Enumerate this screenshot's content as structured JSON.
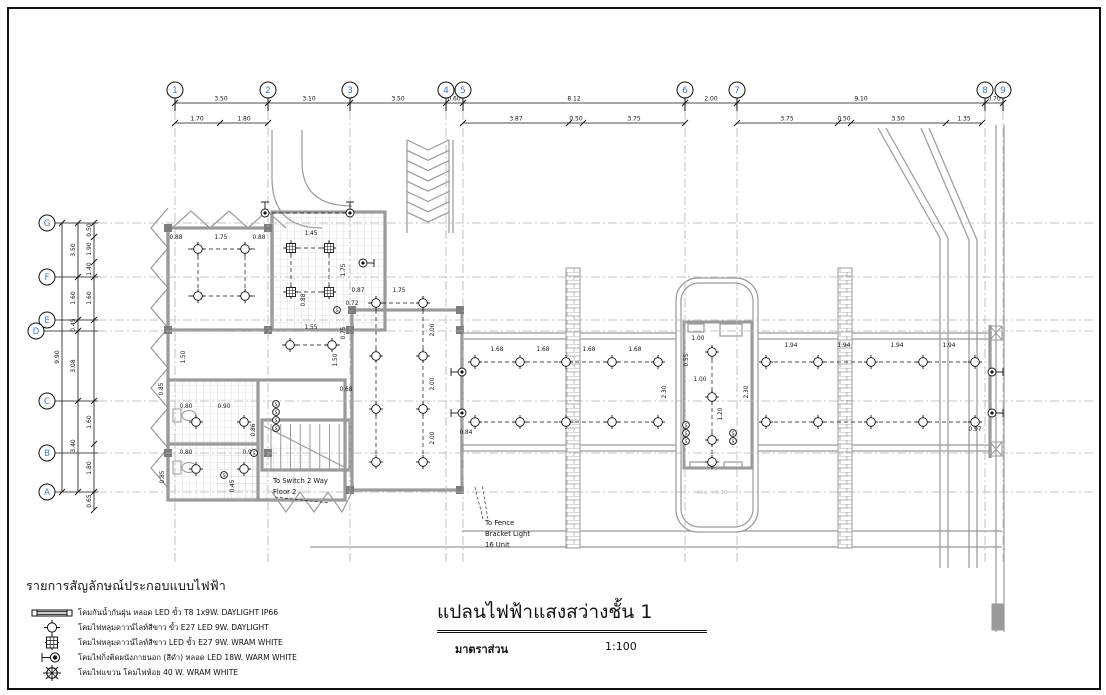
{
  "colors": {
    "line": "#111111",
    "wall": "#9a9a9a",
    "wall_dark": "#7d7d7d",
    "grid": "#b4b4b4",
    "bubble_num": "#3f7cc0",
    "faint": "#bdbdbd",
    "tile": "#c9c9c9"
  },
  "grid": {
    "columns": [
      {
        "label": "1",
        "x": 175
      },
      {
        "label": "2",
        "x": 268
      },
      {
        "label": "3",
        "x": 350
      },
      {
        "label": "4",
        "x": 446
      },
      {
        "label": "5",
        "x": 463
      },
      {
        "label": "6",
        "x": 685
      },
      {
        "label": "7",
        "x": 737
      },
      {
        "label": "8",
        "x": 985
      },
      {
        "label": "9",
        "x": 1003
      }
    ],
    "rows": [
      {
        "label": "G",
        "y": 223
      },
      {
        "label": "F",
        "y": 277
      },
      {
        "label": "E",
        "y": 320
      },
      {
        "label": "D",
        "y": 331
      },
      {
        "label": "C",
        "y": 401
      },
      {
        "label": "B",
        "y": 453
      },
      {
        "label": "A",
        "y": 492
      }
    ],
    "dim_row1": {
      "y": 103,
      "ticks": [
        175,
        268,
        350,
        446,
        463,
        685,
        737,
        985,
        1003
      ],
      "segs": [
        {
          "t": "3.50",
          "x": 221
        },
        {
          "t": "3.10",
          "x": 309
        },
        {
          "t": "3.50",
          "x": 398
        },
        {
          "t": "0.60",
          "x": 454
        },
        {
          "t": "8.12",
          "x": 574
        },
        {
          "t": "2.00",
          "x": 711
        },
        {
          "t": "9.10",
          "x": 861
        },
        {
          "t": "0.70",
          "x": 994
        }
      ]
    },
    "dim_row2": {
      "y": 123,
      "lines": [
        [
          175,
          268
        ],
        [
          463,
          685
        ],
        [
          737,
          982
        ]
      ],
      "ticks": [
        175,
        220,
        268,
        463,
        569,
        583,
        685,
        737,
        838,
        851,
        946,
        982
      ],
      "segs": [
        {
          "t": "1.70",
          "x": 197
        },
        {
          "t": "1.80",
          "x": 244
        },
        {
          "t": "3.87",
          "x": 516
        },
        {
          "t": "0.50",
          "x": 576
        },
        {
          "t": "3.75",
          "x": 634
        },
        {
          "t": "3.75",
          "x": 787
        },
        {
          "t": "0.50",
          "x": 844
        },
        {
          "t": "3.50",
          "x": 898
        },
        {
          "t": "1.35",
          "x": 964
        }
      ]
    },
    "left_dims": {
      "lines": [
        {
          "x": 62,
          "y1": 223,
          "y2": 492
        },
        {
          "x": 78,
          "y1": 223,
          "y2": 492
        },
        {
          "x": 94,
          "y1": 223,
          "y2": 510
        }
      ],
      "ticks": {
        "62": [
          223,
          492
        ],
        "78": [
          223,
          277,
          320,
          331,
          401,
          492
        ],
        "94": [
          223,
          237,
          262,
          277,
          320,
          401,
          444,
          492,
          510
        ]
      },
      "texts": [
        {
          "t": "9.90",
          "x": 62,
          "y": 357
        },
        {
          "t": "3.50",
          "x": 78,
          "y": 250
        },
        {
          "t": "1.60",
          "x": 78,
          "y": 298
        },
        {
          "t": "0.45",
          "x": 78,
          "y": 325
        },
        {
          "t": "3.08",
          "x": 78,
          "y": 366
        },
        {
          "t": "3.40",
          "x": 78,
          "y": 446
        },
        {
          "t": "0.50",
          "x": 94,
          "y": 230
        },
        {
          "t": "1.90",
          "x": 94,
          "y": 249
        },
        {
          "t": "1.40",
          "x": 94,
          "y": 269
        },
        {
          "t": "1.60",
          "x": 94,
          "y": 298
        },
        {
          "t": "1.60",
          "x": 94,
          "y": 422
        },
        {
          "t": "1.80",
          "x": 94,
          "y": 468
        },
        {
          "t": "0.65",
          "x": 94,
          "y": 501
        }
      ]
    }
  },
  "plan": {
    "dims": [
      [
        "0.88",
        176,
        239,
        0
      ],
      [
        "1.75",
        221,
        239,
        0
      ],
      [
        "0.88",
        259,
        239,
        0
      ],
      [
        "1.45",
        311,
        235,
        0
      ],
      [
        "1.75",
        345,
        270,
        1
      ],
      [
        "0.88",
        305,
        300,
        1
      ],
      [
        "0.87",
        358,
        292,
        0
      ],
      [
        "1.75",
        399,
        292,
        0
      ],
      [
        "0.72",
        352,
        305,
        0
      ],
      [
        "1.55",
        311,
        329,
        0
      ],
      [
        "0.75",
        345,
        333,
        1
      ],
      [
        "1.50",
        185,
        357,
        1
      ],
      [
        "1.50",
        337,
        360,
        1
      ],
      [
        "2.00",
        434,
        330,
        1
      ],
      [
        "2.00",
        434,
        384,
        1
      ],
      [
        "2.00",
        434,
        438,
        1
      ],
      [
        "0.68",
        346,
        391,
        0
      ],
      [
        "0.80",
        186,
        408,
        0
      ],
      [
        "0.90",
        224,
        408,
        0
      ],
      [
        "0.85",
        163,
        389,
        1
      ],
      [
        "0.86",
        255,
        430,
        1
      ],
      [
        "0.80",
        186,
        454,
        0
      ],
      [
        "0.90",
        249,
        454,
        0
      ],
      [
        "0.85",
        164,
        477,
        1
      ],
      [
        "0.45",
        234,
        486,
        1
      ],
      [
        "0.84",
        466,
        434,
        0
      ],
      [
        "1.68",
        497,
        351,
        0
      ],
      [
        "1.68",
        543,
        351,
        0
      ],
      [
        "1.68",
        589,
        351,
        0
      ],
      [
        "1.68",
        635,
        351,
        0
      ],
      [
        "2.30",
        666,
        392,
        1
      ],
      [
        "2.30",
        748,
        392,
        1
      ],
      [
        "1.94",
        791,
        347,
        0
      ],
      [
        "1.94",
        844,
        347,
        0
      ],
      [
        "1.94",
        897,
        347,
        0
      ],
      [
        "1.94",
        949,
        347,
        0
      ],
      [
        "0.97",
        975,
        431,
        0
      ],
      [
        "1.00",
        698,
        340,
        0
      ],
      [
        "0.55",
        688,
        360,
        1
      ],
      [
        "1.00",
        700,
        381,
        0
      ],
      [
        "1.20",
        722,
        414,
        1
      ]
    ],
    "lights": {
      "down": [
        [
          198,
          249
        ],
        [
          245,
          249
        ],
        [
          198,
          296
        ],
        [
          245,
          296
        ],
        [
          290,
          345
        ],
        [
          332,
          345
        ],
        [
          196,
          422
        ],
        [
          244,
          422
        ],
        [
          196,
          469
        ],
        [
          244,
          469
        ],
        [
          376,
          303
        ],
        [
          423,
          303
        ],
        [
          376,
          356
        ],
        [
          423,
          356
        ],
        [
          376,
          409
        ],
        [
          423,
          409
        ],
        [
          376,
          462
        ],
        [
          423,
          462
        ],
        [
          475,
          362
        ],
        [
          520,
          362
        ],
        [
          566,
          362
        ],
        [
          612,
          362
        ],
        [
          658,
          362
        ],
        [
          475,
          422
        ],
        [
          520,
          422
        ],
        [
          566,
          422
        ],
        [
          612,
          422
        ],
        [
          658,
          422
        ],
        [
          766,
          362
        ],
        [
          818,
          362
        ],
        [
          871,
          362
        ],
        [
          923,
          362
        ],
        [
          975,
          362
        ],
        [
          766,
          422
        ],
        [
          818,
          422
        ],
        [
          871,
          422
        ],
        [
          923,
          422
        ],
        [
          975,
          422
        ],
        [
          712,
          352
        ],
        [
          712,
          397
        ],
        [
          712,
          440
        ],
        [
          712,
          462
        ]
      ],
      "warm": [
        [
          291,
          248
        ],
        [
          329,
          248
        ],
        [
          291,
          292
        ],
        [
          329,
          292
        ]
      ],
      "bracket": [
        [
          265,
          213,
          "up"
        ],
        [
          350,
          213,
          "up"
        ],
        [
          462,
          372,
          "left"
        ],
        [
          462,
          413,
          "left"
        ],
        [
          992,
          372,
          "right"
        ],
        [
          992,
          413,
          "right"
        ],
        [
          363,
          263,
          "right"
        ]
      ],
      "switch_clusters": [
        [
          276,
          404,
          4
        ],
        [
          686,
          425,
          3
        ],
        [
          733,
          433,
          2
        ],
        [
          224,
          475,
          1
        ],
        [
          254,
          453,
          1
        ],
        [
          337,
          310,
          1
        ]
      ],
      "links": [
        [
          198,
          242,
          198,
          300
        ],
        [
          245,
          242,
          245,
          300
        ],
        [
          188,
          249,
          255,
          249
        ],
        [
          188,
          296,
          255,
          296
        ],
        [
          291,
          240,
          291,
          298
        ],
        [
          329,
          240,
          329,
          298
        ],
        [
          283,
          248,
          337,
          248
        ],
        [
          283,
          292,
          337,
          292
        ],
        [
          376,
          296,
          376,
          468
        ],
        [
          423,
          296,
          423,
          468
        ],
        [
          368,
          303,
          430,
          303
        ],
        [
          470,
          362,
          660,
          362
        ],
        [
          470,
          422,
          660,
          422
        ],
        [
          760,
          362,
          978,
          362
        ],
        [
          760,
          422,
          978,
          422
        ],
        [
          712,
          345,
          712,
          465
        ],
        [
          265,
          213,
          350,
          213
        ],
        [
          282,
          345,
          340,
          345
        ]
      ]
    },
    "annotations": {
      "switch_note": {
        "lines": [
          "To Switch 2 Way",
          "Floor 2"
        ],
        "x": 291,
        "y": 483
      },
      "fence_note": {
        "lines": [
          "To Fence",
          "Bracket Light",
          "16 Unit"
        ],
        "x": 489,
        "y": 525
      },
      "level_note": {
        "text": "คสล. +0.10",
        "x": 712,
        "y": 494
      }
    }
  },
  "legend": {
    "header": "รายการสัญลักษณ์ประกอบแบบไฟฟ้า",
    "items": [
      {
        "symbol": "fluorescent-tube",
        "label": "โคมกันน้ำกันฝุ่น หลอด LED ขั้ว T8 1x9W. DAYLIGHT IP66"
      },
      {
        "symbol": "downlight",
        "label": "โคมไฟหลุมดาวน์ไลท์สีขาว ขั้ว E27 LED 9W. DAYLIGHT"
      },
      {
        "symbol": "downlight-warm",
        "label": "โคมไฟหลุมดาวน์ไลท์สีขาว LED ขั้ว E27 9W. WRAM WHITE"
      },
      {
        "symbol": "wall-bracket",
        "label": "โคมไฟกิ่งติดผนังภายนอก (สีดำ) หลอด LED 18W. WARM WHITE"
      },
      {
        "symbol": "pendant",
        "label": "โคมไฟแขวน โคมไฟห้อย 40 W. WRAM WHITE"
      }
    ]
  },
  "titleblock": {
    "title": "แปลนไฟฟ้าแสงสว่างชั้น 1",
    "scale_label": "มาตราส่วน",
    "scale_value": "1:100"
  }
}
